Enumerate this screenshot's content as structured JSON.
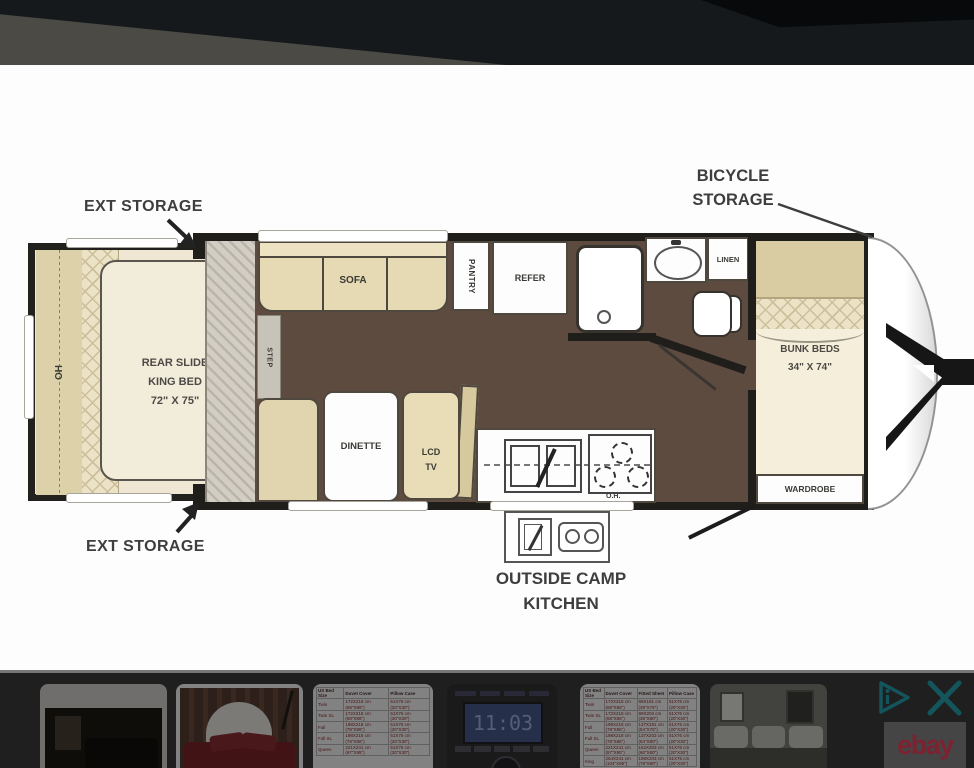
{
  "plan": {
    "callouts": {
      "ext_storage_top": "EXT STORAGE",
      "ext_storage_bottom": "EXT STORAGE",
      "bicycle_line1": "BICYCLE",
      "bicycle_line2": "STORAGE",
      "camp_line1": "OUTSIDE CAMP",
      "camp_line2": "KITCHEN"
    },
    "fixtures": {
      "sofa": "SOFA",
      "pantry": "PANTRY",
      "refer": "REFER",
      "linen": "LINEN",
      "step": "STEP",
      "dinette": "DINETTE",
      "lcd_line1": "LCD",
      "lcd_line2": "TV",
      "oh_kitchen": "O.H.",
      "oh_slide": "OH",
      "wardrobe": "WARDROBE",
      "bunk_line1": "BUNK BEDS",
      "bunk_line2": "34\" X 74\"",
      "king_line1": "REAR SLIDE",
      "king_line2": "KING BED",
      "king_line3": "72\" X 75\""
    },
    "colors": {
      "floor_brown": "#5d4b40",
      "furniture_tan": "#e5dab4",
      "mattress_cream": "#f2ecdb",
      "wall_black": "#201e1b"
    }
  },
  "ad": {
    "ebay_logo": "ebay",
    "accent_teal": "#14555c",
    "ebay_red": "#7e2130",
    "radio_display": "11:03",
    "chart1": {
      "headers": [
        "US Bed Size",
        "Duvet Cover",
        "Pillow Case"
      ],
      "rows": [
        [
          "Twin",
          "172X218 cm (68\"X86\")",
          "51X76 cm (20\"X30\")"
        ],
        [
          "Twin XL",
          "172X218 cm (68\"X86\")",
          "51X76 cm (20\"X30\")"
        ],
        [
          "Full",
          "198X218 cm (78\"X86\")",
          "51X76 cm (20\"X30\")"
        ],
        [
          "Full XL",
          "198X218 cm (78\"X86\")",
          "51X76 cm (20\"X30\")"
        ],
        [
          "Queen",
          "221X241 cm (87\"X95\")",
          "51X76 cm (20\"X30\")"
        ]
      ]
    },
    "chart2": {
      "headers": [
        "US Bed Size",
        "Duvet Cover",
        "Fitted Sheet",
        "Pillow Case"
      ],
      "rows": [
        [
          "Twin",
          "172X218 cm (68\"X86\")",
          "99X191 cm (39\"X75\")",
          "51X76 cm (20\"X30\")"
        ],
        [
          "Twin XL",
          "172X218 cm (68\"X86\")",
          "99X203 cm (39\"X80\")",
          "51X76 cm (20\"X30\")"
        ],
        [
          "Full",
          "198X218 cm (78\"X86\")",
          "137X191 cm (54\"X75\")",
          "51X76 cm (20\"X30\")"
        ],
        [
          "Full XL",
          "198X218 cm (78\"X86\")",
          "137X203 cm (54\"X80\")",
          "51X76 cm (20\"X30\")"
        ],
        [
          "Queen",
          "221X241 cm (87\"X95\")",
          "152X203 cm (60\"X80\")",
          "51X76 cm (20\"X30\")"
        ],
        [
          "King",
          "264X241 cm (104\"X95\")",
          "198X203 cm (78\"X80\")",
          "51X76 cm (20\"X30\")"
        ]
      ]
    }
  }
}
